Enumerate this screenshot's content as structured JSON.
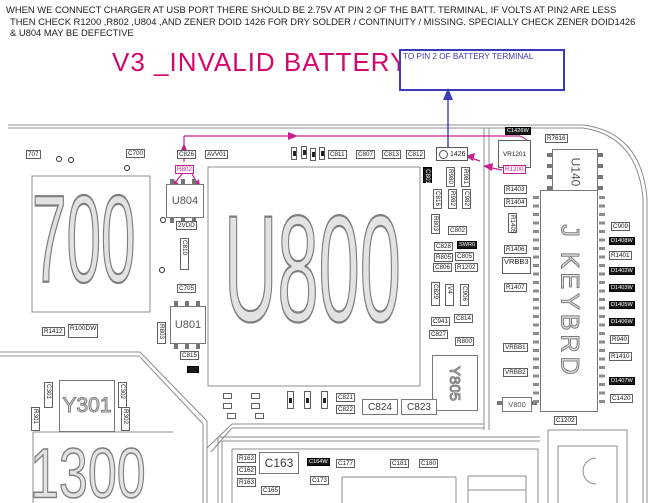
{
  "header": {
    "lines": [
      "WHEN WE CONNECT CHARGER AT USB PORT THERE SHOULD BE 2.75V AT PIN 2 OF THE BATT. TERMINAL, IF VOLTS AT PIN2 ARE LESS",
      "THEN CHECK R1200 ,R802 ,U804 ,AND ZENER DOID 1426 FOR DRY SOLDER / CONTINUITY / MISSING. SPECIALLY CHECK ZENER DOID1426",
      "& U804 MAY BE DEFECTIVE"
    ]
  },
  "title": {
    "text": "V3 _INVALID BATTERY"
  },
  "callout": {
    "text": "TO PIN 2 OF BATTERY TERMINAL"
  },
  "colors": {
    "pink": "#d4076e",
    "magenta": "#c42090",
    "blue": "#3b3bb8",
    "line": "#8c8c8c"
  },
  "pcb": {
    "items": [
      {
        "id": "c707-label",
        "text": "707",
        "type": "box",
        "x": 26,
        "y": 150
      },
      {
        "id": "c700-label",
        "text": "C700",
        "type": "box",
        "x": 126,
        "y": 149
      },
      {
        "id": "c826-label",
        "text": "C826",
        "type": "box",
        "x": 177,
        "y": 150
      },
      {
        "id": "avv01-label",
        "text": "AVV01",
        "type": "box",
        "x": 205,
        "y": 150
      },
      {
        "id": "pin-a",
        "text": "",
        "type": "tinyv",
        "x": 291,
        "y": 147,
        "w": 6,
        "h": 13
      },
      {
        "id": "pin-b",
        "text": "",
        "type": "tinyv",
        "x": 301,
        "y": 146,
        "w": 6,
        "h": 13
      },
      {
        "id": "pin-c",
        "text": "",
        "type": "tinyv",
        "x": 310,
        "y": 148,
        "w": 6,
        "h": 13
      },
      {
        "id": "pin-d",
        "text": "",
        "type": "tinyv",
        "x": 319,
        "y": 147,
        "w": 6,
        "h": 13
      },
      {
        "id": "c811-label",
        "text": "C811",
        "type": "box",
        "x": 328,
        "y": 150
      },
      {
        "id": "c807-label",
        "text": "C807",
        "type": "box",
        "x": 356,
        "y": 150
      },
      {
        "id": "c813-label",
        "text": "C813",
        "type": "box",
        "x": 382,
        "y": 150
      },
      {
        "id": "c812-label",
        "text": "C812",
        "type": "box",
        "x": 406,
        "y": 150
      },
      {
        "id": "d1426-zener",
        "text": "1426",
        "type": "diode",
        "x": 436,
        "y": 147,
        "w": 32,
        "h": 14
      },
      {
        "id": "c1426w-label",
        "text": "C1426W",
        "type": "dark",
        "x": 505,
        "y": 127
      },
      {
        "id": "r7616-label",
        "text": "R7616",
        "type": "box",
        "x": 545,
        "y": 134
      },
      {
        "id": "vr1201",
        "text": "VR1201",
        "type": "chipbox",
        "x": 498,
        "y": 140,
        "w": 33,
        "h": 28
      },
      {
        "id": "u140",
        "text": "U140",
        "type": "chip pins-lr rot90",
        "x": 552,
        "y": 149,
        "w": 46,
        "h": 46,
        "fs": 12
      },
      {
        "id": "r802-label",
        "text": "R802",
        "type": "mbox",
        "x": 175,
        "y": 165
      },
      {
        "id": "r1200-label",
        "text": "R1200",
        "type": "mbox",
        "x": 503,
        "y": 165
      },
      {
        "id": "u804",
        "text": "U804",
        "type": "chip pins-tb",
        "x": 166,
        "y": 184,
        "w": 38,
        "h": 34
      },
      {
        "id": "vdd2-label",
        "text": "2VDD",
        "type": "box",
        "x": 176,
        "y": 221
      },
      {
        "id": "c810-label",
        "text": "C810",
        "type": "vbox",
        "x": 180,
        "y": 238,
        "h": 32
      },
      {
        "id": "c705-label",
        "text": "C705",
        "type": "box",
        "x": 177,
        "y": 284
      },
      {
        "id": "u801",
        "text": "U801",
        "type": "chip pins-tb",
        "x": 170,
        "y": 306,
        "w": 36,
        "h": 38
      },
      {
        "id": "r803-left-label",
        "text": "R803",
        "type": "vbox",
        "x": 157,
        "y": 322,
        "h": 22
      },
      {
        "id": "c815-label",
        "text": "C815",
        "type": "box",
        "x": 180,
        "y": 351
      },
      {
        "id": "d18-mark",
        "text": "",
        "type": "dark",
        "x": 187,
        "y": 366,
        "w": 12,
        "h": 7
      },
      {
        "id": "via-1",
        "text": "",
        "type": "dot",
        "x": 56,
        "y": 156
      },
      {
        "id": "via-2",
        "text": "",
        "type": "dot",
        "x": 68,
        "y": 157
      },
      {
        "id": "via-3",
        "text": "",
        "type": "dot",
        "x": 124,
        "y": 165
      },
      {
        "id": "via-4",
        "text": "",
        "type": "dot",
        "x": 160,
        "y": 217
      },
      {
        "id": "via-5",
        "text": "",
        "type": "dot",
        "x": 159,
        "y": 267
      },
      {
        "id": "c801-label",
        "text": "C801",
        "type": "vdark",
        "x": 423,
        "y": 167,
        "h": 16
      },
      {
        "id": "r980-label",
        "text": "R980",
        "type": "vbox",
        "x": 446,
        "y": 167,
        "h": 20
      },
      {
        "id": "r981-label",
        "text": "R981",
        "type": "vbox",
        "x": 461,
        "y": 167,
        "h": 20
      },
      {
        "id": "c816-label",
        "text": "C816",
        "type": "vbox",
        "x": 433,
        "y": 189,
        "h": 20
      },
      {
        "id": "r982-label",
        "text": "R982",
        "type": "vbox",
        "x": 448,
        "y": 189,
        "h": 20
      },
      {
        "id": "c982-label",
        "text": "C982",
        "type": "vbox",
        "x": 462,
        "y": 189,
        "h": 20
      },
      {
        "id": "r803-mid-label",
        "text": "R803",
        "type": "vbox",
        "x": 431,
        "y": 214,
        "h": 20
      },
      {
        "id": "c802-label",
        "text": "C802",
        "type": "box",
        "x": 448,
        "y": 226
      },
      {
        "id": "c828-label",
        "text": "C828",
        "type": "box",
        "x": 434,
        "y": 242
      },
      {
        "id": "swr0-label",
        "text": "SWR0",
        "type": "dark",
        "x": 457,
        "y": 241
      },
      {
        "id": "r805-label",
        "text": "R805",
        "type": "box",
        "x": 434,
        "y": 253
      },
      {
        "id": "c805-label",
        "text": "C805",
        "type": "box",
        "x": 455,
        "y": 252
      },
      {
        "id": "c806-label",
        "text": "C806",
        "type": "box",
        "x": 433,
        "y": 263
      },
      {
        "id": "r1202-label",
        "text": "R1202",
        "type": "box",
        "x": 455,
        "y": 263
      },
      {
        "id": "c829-label",
        "text": "C829",
        "type": "vbox",
        "x": 431,
        "y": 282,
        "h": 24
      },
      {
        "id": "v4-label",
        "text": "V4",
        "type": "vbox",
        "x": 445,
        "y": 284,
        "h": 22
      },
      {
        "id": "c906-label",
        "text": "C906",
        "type": "vbox",
        "x": 460,
        "y": 284,
        "h": 22
      },
      {
        "id": "c941-label",
        "text": "C941",
        "type": "box",
        "x": 431,
        "y": 317
      },
      {
        "id": "c814-label",
        "text": "C814",
        "type": "box",
        "x": 454,
        "y": 314
      },
      {
        "id": "c827-label",
        "text": "C827",
        "type": "box",
        "x": 429,
        "y": 330
      },
      {
        "id": "r800-label",
        "text": "R800",
        "type": "box",
        "x": 455,
        "y": 337
      },
      {
        "id": "y805",
        "text": "Y805",
        "type": "bigbox rot90 outl",
        "x": 432,
        "y": 355,
        "w": 46,
        "h": 56,
        "fs": 15
      },
      {
        "id": "r1403-label",
        "text": "R1403",
        "type": "box",
        "x": 504,
        "y": 185
      },
      {
        "id": "r1404-label",
        "text": "R1404",
        "type": "box",
        "x": 504,
        "y": 198
      },
      {
        "id": "r1405-label",
        "text": "R1405",
        "type": "vbox",
        "x": 508,
        "y": 213,
        "h": 20
      },
      {
        "id": "r1406-label",
        "text": "R1406",
        "type": "box",
        "x": 504,
        "y": 245
      },
      {
        "id": "vrbb3-label",
        "text": "VRBB3",
        "type": "box",
        "x": 502,
        "y": 257,
        "fs": 7.5,
        "h": 17
      },
      {
        "id": "r1407-label",
        "text": "R1407",
        "type": "box",
        "x": 504,
        "y": 283
      },
      {
        "id": "vrbb1-label",
        "text": "VRBB1",
        "type": "box",
        "x": 503,
        "y": 343
      },
      {
        "id": "vrbb2-label",
        "text": "VRBB2",
        "type": "box",
        "x": 503,
        "y": 368
      },
      {
        "id": "v800",
        "text": "V800",
        "type": "chip pins-lr",
        "x": 502,
        "y": 397,
        "w": 30,
        "h": 15,
        "fs": 7.5
      },
      {
        "id": "kbd-teeth-left",
        "text": "",
        "type": "teethv",
        "x": 533,
        "y": 196,
        "w": 6,
        "h": 210
      },
      {
        "id": "kbd-teeth-right",
        "text": "",
        "type": "teethv",
        "x": 599,
        "y": 196,
        "w": 6,
        "h": 210
      },
      {
        "id": "j-keybrd",
        "text": "J KEYBRD",
        "type": "bigbox rot90 outl",
        "x": 540,
        "y": 190,
        "w": 58,
        "h": 222,
        "fs": 25,
        "ls": 4
      },
      {
        "id": "c909-label",
        "text": "C909",
        "type": "box",
        "x": 611,
        "y": 222
      },
      {
        "id": "d1408w-label",
        "text": "D1408W",
        "type": "dark",
        "x": 609,
        "y": 237
      },
      {
        "id": "r1401-label",
        "text": "R1401",
        "type": "box",
        "x": 609,
        "y": 251
      },
      {
        "id": "d1402w-label",
        "text": "D1402W",
        "type": "dark",
        "x": 609,
        "y": 267
      },
      {
        "id": "d1403w-label",
        "text": "D1403W",
        "type": "dark",
        "x": 609,
        "y": 284
      },
      {
        "id": "d1405w-label",
        "text": "D1405W",
        "type": "dark",
        "x": 609,
        "y": 301
      },
      {
        "id": "d1406w-label",
        "text": "D1406W",
        "type": "dark",
        "x": 609,
        "y": 318
      },
      {
        "id": "r940-label",
        "text": "R940",
        "type": "box",
        "x": 610,
        "y": 335
      },
      {
        "id": "r1410-label",
        "text": "R1410",
        "type": "box",
        "x": 609,
        "y": 352
      },
      {
        "id": "d1407w-label",
        "text": "D1407W",
        "type": "dark",
        "x": 609,
        "y": 377
      },
      {
        "id": "c1420-label",
        "text": "C1420",
        "type": "box",
        "x": 610,
        "y": 394
      },
      {
        "id": "c1202-label",
        "text": "C1202",
        "type": "box",
        "x": 554,
        "y": 416
      },
      {
        "id": "r1412-label",
        "text": "R1412",
        "type": "box",
        "x": 42,
        "y": 327
      },
      {
        "id": "r100dw-label",
        "text": "R100DW",
        "type": "box",
        "x": 68,
        "y": 324,
        "fs": 6.5,
        "h": 14
      },
      {
        "id": "c301-label",
        "text": "C301",
        "type": "vbox",
        "x": 44,
        "y": 382,
        "h": 26
      },
      {
        "id": "c302-label",
        "text": "C302",
        "type": "vbox",
        "x": 118,
        "y": 382,
        "h": 26
      },
      {
        "id": "r301-label",
        "text": "R301",
        "type": "vbox",
        "x": 31,
        "y": 407,
        "h": 24
      },
      {
        "id": "r302-label",
        "text": "R302",
        "type": "vbox",
        "x": 121,
        "y": 407,
        "h": 24
      },
      {
        "id": "y301",
        "text": "Y301",
        "type": "bigbox outl",
        "x": 59,
        "y": 380,
        "w": 56,
        "h": 52,
        "fs": 21
      },
      {
        "id": "u700-silk",
        "text": "700",
        "type": "big",
        "x": 32,
        "y": 182,
        "fs": 62,
        "sy": 2.0
      },
      {
        "id": "u800-silk",
        "text": "U800",
        "type": "big",
        "x": 224,
        "y": 196,
        "fs": 74,
        "sy": 2.05
      },
      {
        "id": "u1300-silk",
        "text": "1300",
        "type": "big",
        "x": 30,
        "y": 442,
        "fs": 52,
        "sy": 1.35
      },
      {
        "id": "tiny-1",
        "text": "",
        "type": "tiny",
        "x": 223,
        "y": 393,
        "w": 9,
        "h": 6
      },
      {
        "id": "tiny-2",
        "text": "",
        "type": "tiny",
        "x": 223,
        "y": 403,
        "w": 9,
        "h": 6
      },
      {
        "id": "tiny-3",
        "text": "",
        "type": "tiny",
        "x": 227,
        "y": 413,
        "w": 9,
        "h": 6
      },
      {
        "id": "tiny-4",
        "text": "",
        "type": "tiny",
        "x": 251,
        "y": 393,
        "w": 9,
        "h": 6
      },
      {
        "id": "tiny-5",
        "text": "",
        "type": "tiny",
        "x": 251,
        "y": 403,
        "w": 9,
        "h": 6
      },
      {
        "id": "tiny-6",
        "text": "",
        "type": "tiny",
        "x": 255,
        "y": 413,
        "w": 9,
        "h": 6
      },
      {
        "id": "tinyv-1",
        "text": "",
        "type": "tinyv",
        "x": 287,
        "y": 391,
        "w": 7,
        "h": 18
      },
      {
        "id": "tinyv-2",
        "text": "",
        "type": "tinyv",
        "x": 304,
        "y": 391,
        "w": 7,
        "h": 18
      },
      {
        "id": "tinyv-3",
        "text": "",
        "type": "tinyv",
        "x": 321,
        "y": 391,
        "w": 7,
        "h": 18
      },
      {
        "id": "c821-label",
        "text": "C821",
        "type": "box",
        "x": 336,
        "y": 393
      },
      {
        "id": "c822-label",
        "text": "C822",
        "type": "box",
        "x": 336,
        "y": 405
      },
      {
        "id": "c824",
        "text": "C824",
        "type": "bigbox",
        "x": 362,
        "y": 399,
        "w": 36,
        "h": 16,
        "fs": 10
      },
      {
        "id": "c823",
        "text": "C823",
        "type": "bigbox",
        "x": 401,
        "y": 399,
        "w": 36,
        "h": 16,
        "fs": 10
      },
      {
        "id": "r162-label",
        "text": "R162",
        "type": "box",
        "x": 237,
        "y": 454
      },
      {
        "id": "c162-label",
        "text": "C162",
        "type": "box",
        "x": 237,
        "y": 466
      },
      {
        "id": "r163-label",
        "text": "R163",
        "type": "box",
        "x": 237,
        "y": 478
      },
      {
        "id": "c163",
        "text": "C163",
        "type": "bigbox",
        "x": 259,
        "y": 452,
        "w": 40,
        "h": 22,
        "fs": 12
      },
      {
        "id": "c165-label",
        "text": "C165",
        "type": "box",
        "x": 261,
        "y": 486
      },
      {
        "id": "c164w-label",
        "text": "C164W",
        "type": "dark",
        "x": 307,
        "y": 458
      },
      {
        "id": "c173-label",
        "text": "C173",
        "type": "box",
        "x": 310,
        "y": 476
      },
      {
        "id": "c177-label",
        "text": "C177",
        "type": "box",
        "x": 336,
        "y": 459
      },
      {
        "id": "c181-label",
        "text": "C181",
        "type": "box",
        "x": 390,
        "y": 459
      },
      {
        "id": "c180-label",
        "text": "C180",
        "type": "box",
        "x": 419,
        "y": 459
      }
    ]
  }
}
